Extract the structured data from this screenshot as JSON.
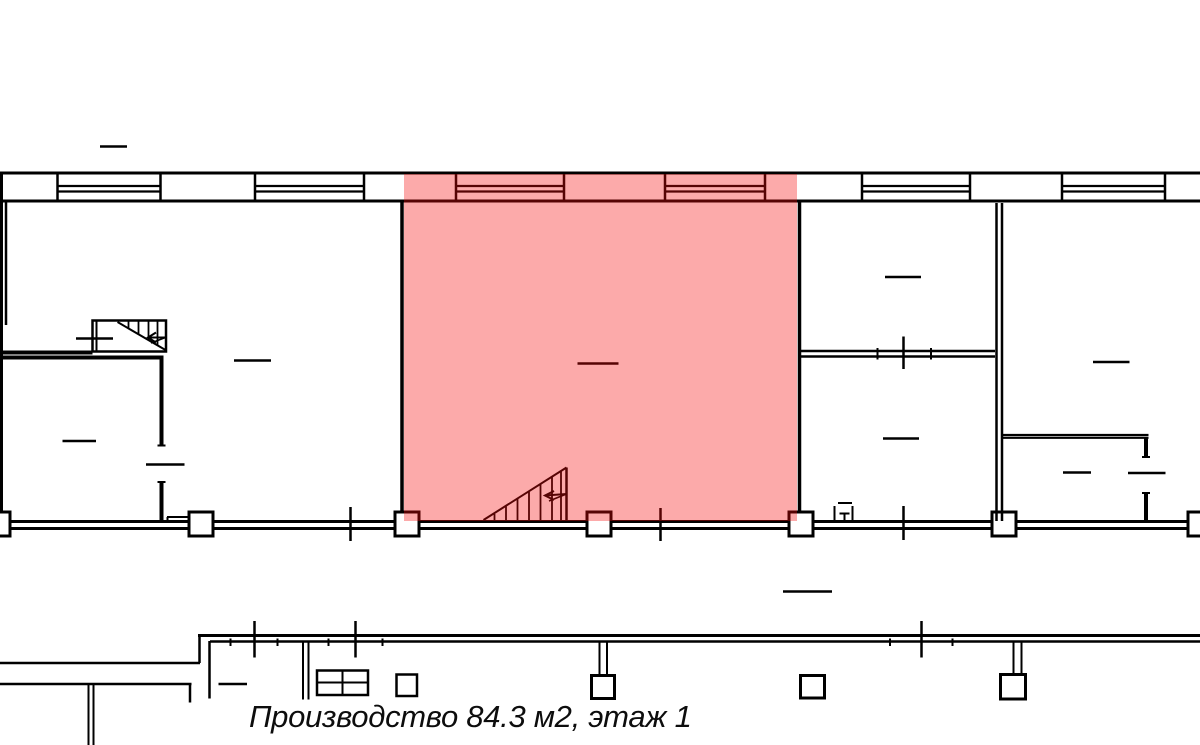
{
  "caption": {
    "text": "Производство 84.3 м2, этаж 1",
    "room_type": "Производство",
    "area": "84.3 м2",
    "floor": "этаж 1"
  },
  "highlight": {
    "name": "production-room-highlight",
    "color": "#f60c0c",
    "opacity": "0.35"
  },
  "colors": {
    "line": "#000000",
    "background": "#ffffff"
  }
}
